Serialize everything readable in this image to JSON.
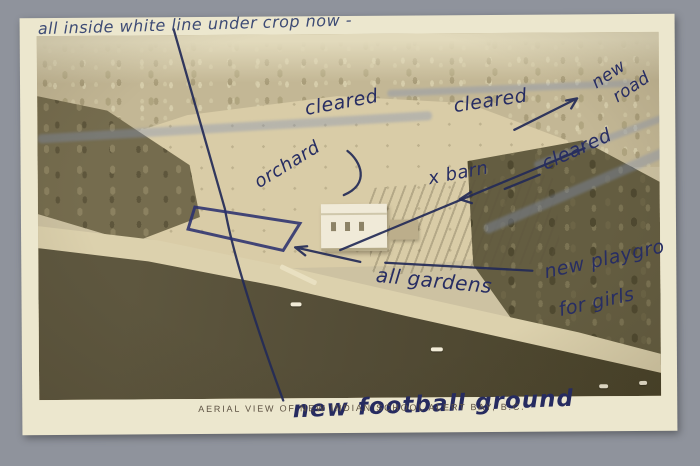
{
  "scene": {
    "background_color": "#8f939c",
    "card_color": "#ece7ce",
    "ink_color": "#232a57",
    "photo_land_color": "#d9cca7",
    "photo_water_color": "#534c36",
    "silvering_streak_color": "#8291b4"
  },
  "caption": {
    "text": "AERIAL VIEW OF NEW INDIAN SCHOOL ALERT BAY, B.C."
  },
  "annotations": {
    "top_note": "all inside white line under crop now -",
    "cleared_left": "cleared",
    "cleared_center": "cleared",
    "new_road_word1": "new",
    "new_road_word2": "road",
    "cleared_right": "cleared",
    "orchard": "orchard",
    "barn": "x barn",
    "all_gardens": "all gardens",
    "playground_line1": "new playgro",
    "playground_line2": "for girls",
    "football_ground": "new football ground"
  }
}
